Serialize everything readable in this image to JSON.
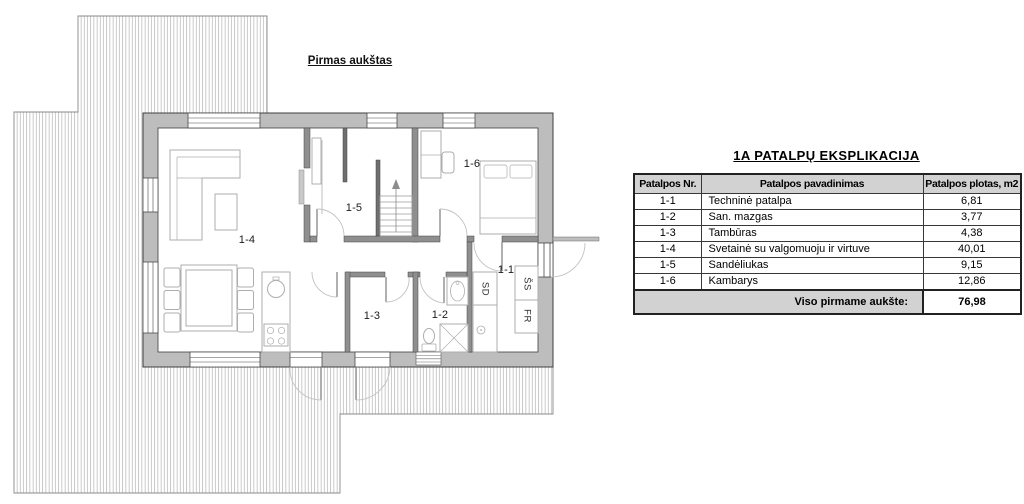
{
  "plan": {
    "title": "Pirmas aukštas",
    "rooms": [
      {
        "id": "1-4",
        "label": "1-4"
      },
      {
        "id": "1-5",
        "label": "1-5"
      },
      {
        "id": "1-6",
        "label": "1-6"
      },
      {
        "id": "1-1",
        "label": "1-1"
      },
      {
        "id": "1-3",
        "label": "1-3"
      },
      {
        "id": "1-2",
        "label": "1-2"
      }
    ],
    "appliances": [
      {
        "label": "SD"
      },
      {
        "label": "ŠS"
      },
      {
        "label": "FR"
      }
    ]
  },
  "table": {
    "title": "1A PATALPŲ EKSPLIKACIJA",
    "columns": [
      "Patalpos Nr.",
      "Patalpos pavadinimas",
      "Patalpos plotas, m2"
    ],
    "rows": [
      {
        "nr": "1-1",
        "name": "Techninė patalpa",
        "area": "6,81"
      },
      {
        "nr": "1-2",
        "name": "San. mazgas",
        "area": "3,77"
      },
      {
        "nr": "1-3",
        "name": "Tambūras",
        "area": "4,38"
      },
      {
        "nr": "1-4",
        "name": "Svetainė su valgomuoju ir virtuve",
        "area": "40,01"
      },
      {
        "nr": "1-5",
        "name": "Sandėliukas",
        "area": "9,15"
      },
      {
        "nr": "1-6",
        "name": "Kambarys",
        "area": "12,86"
      }
    ],
    "total_label": "Viso pirmame aukšte:",
    "total_value": "76,98"
  },
  "colors": {
    "wall_fill": "#bdbdbd",
    "interior_wall_fill": "#8f8f8f",
    "hatch_line": "#a6a6a6",
    "header_bg": "#d2d2d2",
    "table_border": "#222222"
  }
}
